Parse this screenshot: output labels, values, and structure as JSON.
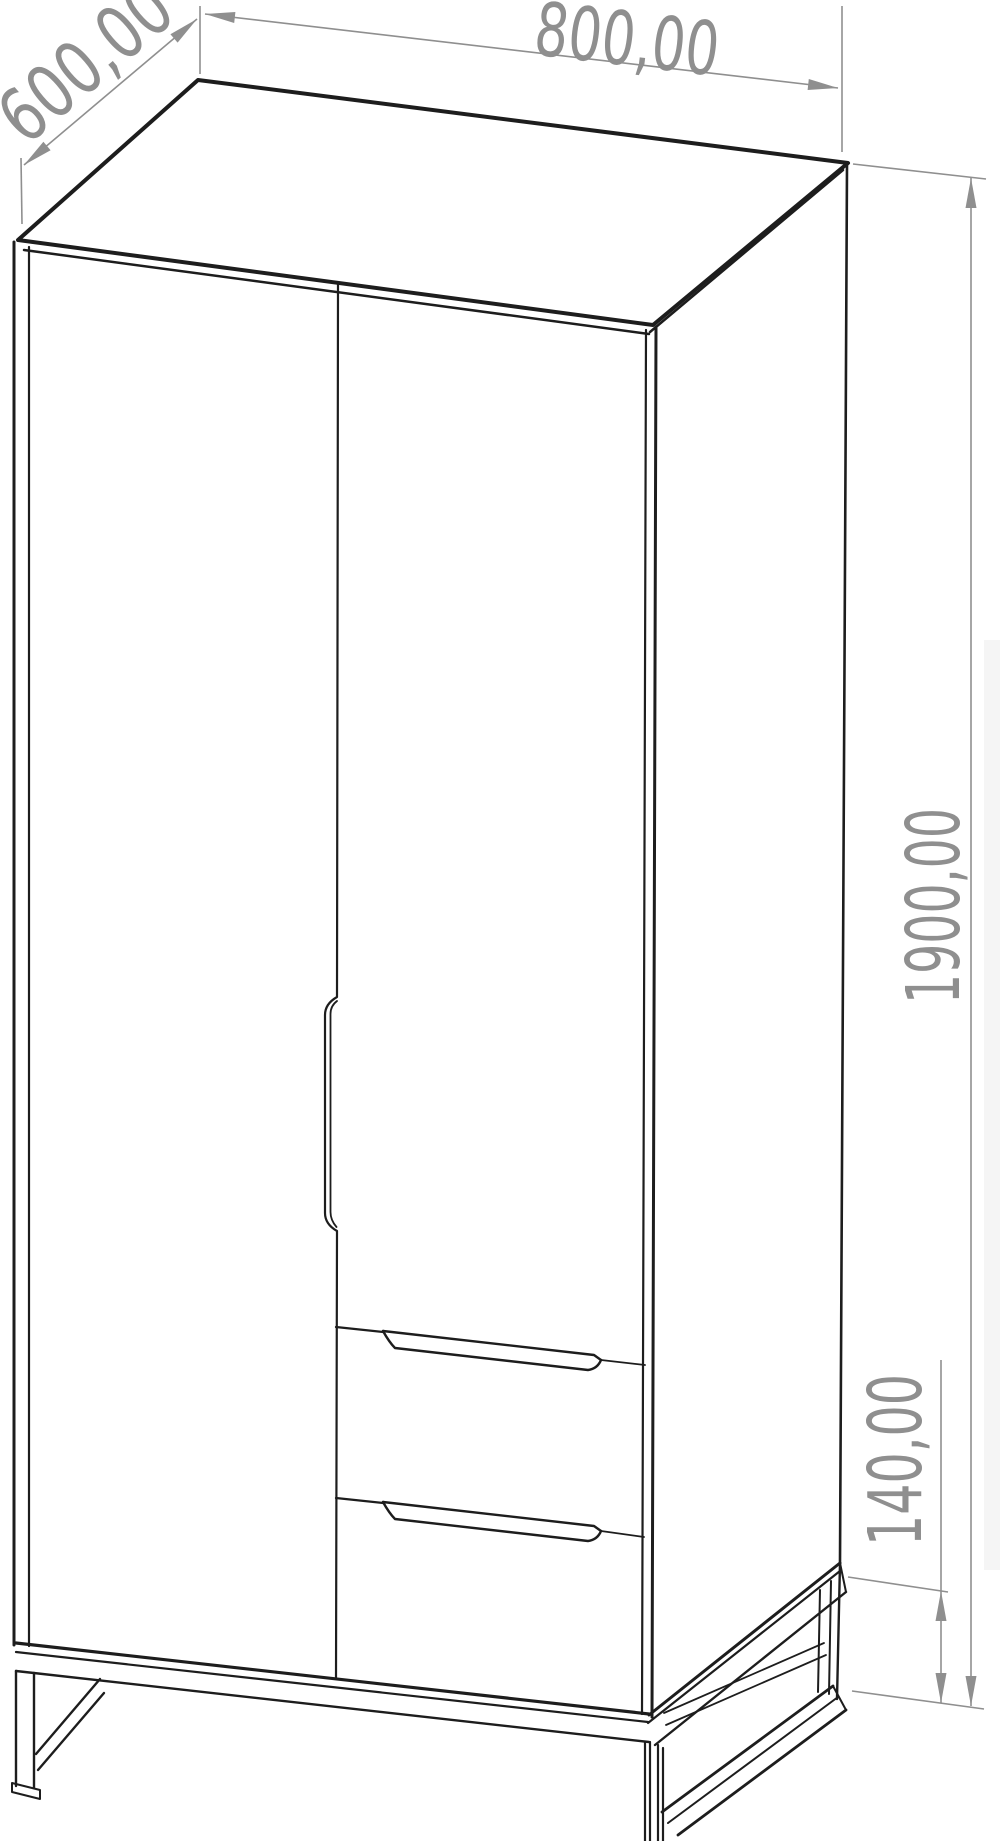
{
  "drawing": {
    "title": "wardrobe-dimensional-drawing",
    "labels": {
      "depth": "600,00",
      "width": "800,00",
      "height": "1900,00",
      "base_height": "140,00"
    },
    "colors": {
      "object_line": "#1d1d1d",
      "dimension": "#8f8f8f",
      "background": "#ffffff"
    }
  }
}
